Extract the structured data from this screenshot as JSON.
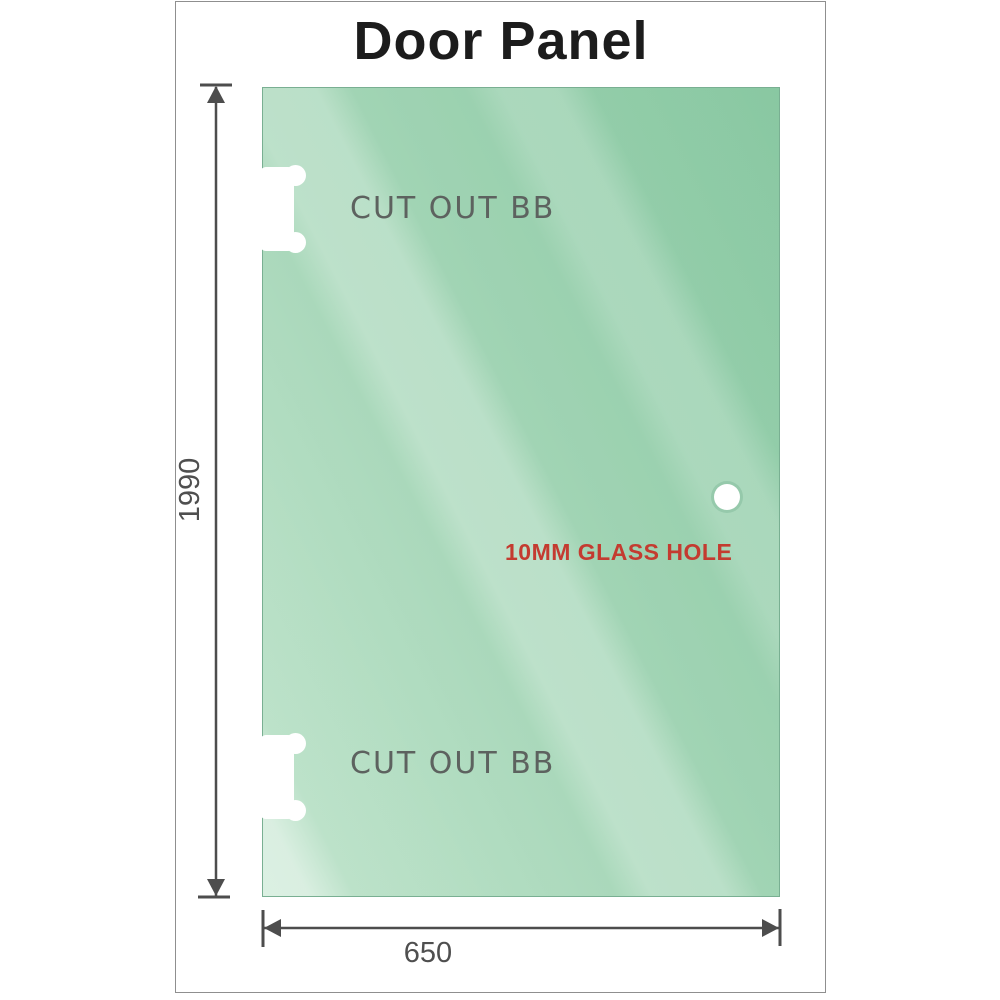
{
  "title": "Door Panel",
  "panel": {
    "cutouts": [
      {
        "label": "CUT OUT BB"
      },
      {
        "label": "CUT OUT BB"
      }
    ],
    "glass_hole": {
      "label": "10MM GLASS HOLE"
    }
  },
  "dimensions": {
    "height": "1990",
    "width": "650"
  },
  "colors": {
    "glass_green": "#98cfad",
    "glass_green_dark": "#89c8a2",
    "glass_green_light": "#b7e0c5",
    "dimension_gray": "#4d4d4d",
    "cutout_label_gray": "#5d625f",
    "glass_hole_label_red": "#c43b30",
    "title_color": "#1c1c1c",
    "frame_border": "#8f8f8f"
  }
}
